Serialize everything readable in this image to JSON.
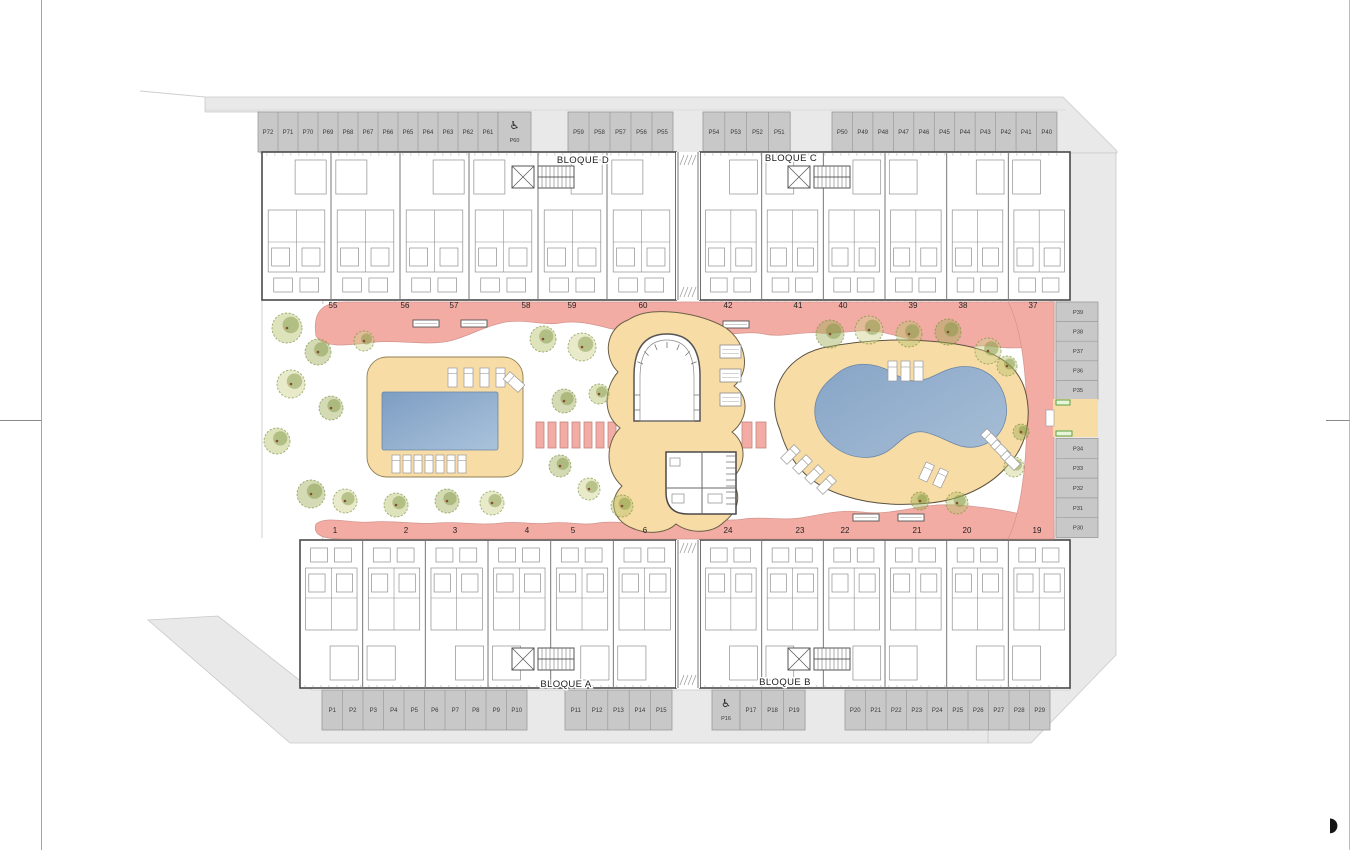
{
  "colors": {
    "pavement": "#e9e9e9",
    "pavement_border": "#c9c9c9",
    "stall": "#c8c8c8",
    "stall_border": "#9a9a9a",
    "walkway_pink": "#f2aca4",
    "walkway_border": "#d2958e",
    "deck_tan": "#f8dca6",
    "deck_border": "#8f7f54",
    "pool_blue_1": "#7d9dc2",
    "pool_blue_2": "#aac3dc",
    "wall_dark": "#4a4a4a",
    "wall_light": "#8f8f8f",
    "tree_dark": "#75903e",
    "accent_green": "#4a9b3a",
    "text": "#2e2e2e"
  },
  "plan": {
    "blocks": [
      {
        "id": "A",
        "label": "BLOQUE A"
      },
      {
        "id": "B",
        "label": "BLOQUE B"
      },
      {
        "id": "C",
        "label": "BLOQUE C"
      },
      {
        "id": "D",
        "label": "BLOQUE D"
      }
    ],
    "parking": {
      "top_row": [
        {
          "stalls": [
            "P72",
            "P71",
            "P70",
            "P69",
            "P68",
            "P67",
            "P66",
            "P65",
            "P64",
            "P63",
            "P62",
            "P61"
          ]
        },
        {
          "accessible": true,
          "label": "P60"
        },
        {
          "stalls": [
            "P59",
            "P58",
            "P57",
            "P56",
            "P55"
          ]
        },
        {
          "stalls": [
            "P54",
            "P53",
            "P52",
            "P51"
          ]
        },
        {
          "stalls": [
            "P50",
            "P49",
            "P48",
            "P47",
            "P46",
            "P45",
            "P44",
            "P43",
            "P42",
            "P41",
            "P40"
          ]
        }
      ],
      "bottom_row": [
        {
          "stalls": [
            "P1",
            "P2",
            "P3",
            "P4",
            "P5",
            "P6",
            "P7",
            "P8",
            "P9",
            "P10"
          ]
        },
        {
          "stalls": [
            "P11",
            "P12",
            "P13",
            "P14",
            "P15"
          ]
        },
        {
          "accessible": true,
          "label": "P16"
        },
        {
          "stalls": [
            "P17",
            "P18",
            "P19"
          ]
        },
        {
          "stalls": [
            "P20",
            "P21",
            "P22",
            "P23",
            "P24",
            "P25",
            "P26",
            "P27",
            "P28",
            "P29"
          ]
        }
      ],
      "right_column": [
        {
          "stalls": [
            "P39",
            "P38",
            "P37",
            "P36",
            "P35"
          ]
        },
        {
          "stalls": [
            "P34",
            "P33",
            "P32",
            "P31",
            "P30"
          ]
        }
      ]
    },
    "unit_numbers": {
      "top_left": [
        "55",
        "56",
        "57",
        "58",
        "59",
        "60"
      ],
      "top_right": [
        "42",
        "41",
        "40",
        "39",
        "38",
        "37"
      ],
      "bottom_left": [
        "1",
        "2",
        "3",
        "4",
        "5",
        "6"
      ],
      "bottom_right": [
        "24",
        "23",
        "22",
        "21",
        "20",
        "19"
      ]
    },
    "icons": {
      "accessible_symbol": "♿"
    }
  }
}
